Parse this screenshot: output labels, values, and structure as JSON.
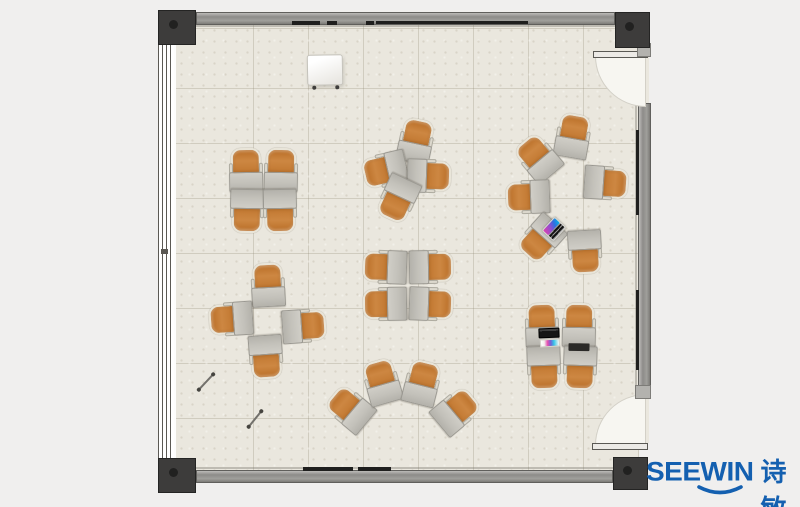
{
  "logo": {
    "brand": "SEEWIN",
    "brand_cn": "诗敏",
    "color": "#1460b0"
  },
  "floorplan": {
    "colors": {
      "background": "#f0efee",
      "floor": "#eae7de",
      "wall": "#8d8c89",
      "corner_post": "#3d3c3b",
      "chair": "#c87c37",
      "chair_trim": "#e9e5d9",
      "desk": "#c3c1ba",
      "wall_mark": "#1f1f1e"
    },
    "clusters": [
      {
        "name": "quad-top-left",
        "units": [
          {
            "x": 246,
            "y": 170,
            "r": -1
          },
          {
            "x": 281,
            "y": 170,
            "r": 1
          },
          {
            "x": 247,
            "y": 211,
            "r": 181
          },
          {
            "x": 280,
            "y": 211,
            "r": 179
          }
        ]
      },
      {
        "name": "quad-rotated-top-center",
        "units": [
          {
            "x": 416,
            "y": 141,
            "r": 12
          },
          {
            "x": 385,
            "y": 170,
            "r": -103
          },
          {
            "x": 429,
            "y": 176,
            "r": 92
          },
          {
            "x": 398,
            "y": 199,
            "r": -155
          }
        ]
      },
      {
        "name": "circle-right",
        "units": [
          {
            "x": 573,
            "y": 136,
            "r": 10
          },
          {
            "x": 538,
            "y": 158,
            "r": -40
          },
          {
            "x": 528,
            "y": 197,
            "r": -92
          },
          {
            "x": 541,
            "y": 239,
            "r": -138
          },
          {
            "x": 585,
            "y": 252,
            "r": 177
          },
          {
            "x": 606,
            "y": 183,
            "r": 94
          }
        ]
      },
      {
        "name": "quad-center",
        "units": [
          {
            "x": 385,
            "y": 267,
            "r": -88
          },
          {
            "x": 385,
            "y": 304,
            "r": -91
          },
          {
            "x": 431,
            "y": 267,
            "r": 89
          },
          {
            "x": 431,
            "y": 304,
            "r": 92
          }
        ]
      },
      {
        "name": "cross-left",
        "units": [
          {
            "x": 268,
            "y": 285,
            "r": -3
          },
          {
            "x": 231,
            "y": 319,
            "r": -94
          },
          {
            "x": 304,
            "y": 326,
            "r": 86
          },
          {
            "x": 266,
            "y": 357,
            "r": 176
          }
        ]
      },
      {
        "name": "arc-bottom-center",
        "units": [
          {
            "x": 350,
            "y": 409,
            "r": -50
          },
          {
            "x": 382,
            "y": 382,
            "r": -16
          },
          {
            "x": 422,
            "y": 383,
            "r": 14
          },
          {
            "x": 456,
            "y": 411,
            "r": 50
          }
        ]
      },
      {
        "name": "quad-bottom-right",
        "units": [
          {
            "x": 542,
            "y": 325,
            "r": -2
          },
          {
            "x": 579,
            "y": 325,
            "r": 1
          },
          {
            "x": 544,
            "y": 368,
            "r": 178
          },
          {
            "x": 580,
            "y": 368,
            "r": 182
          }
        ]
      }
    ],
    "objects": [
      {
        "type": "flipchart",
        "name": "flipchart-board",
        "x": 325,
        "y": 70,
        "w": 34,
        "h": 29,
        "r": -1
      },
      {
        "type": "open-laptop",
        "name": "open-laptop",
        "x": 554,
        "y": 229,
        "w": 19,
        "h": 16,
        "r": -47
      },
      {
        "type": "laptop",
        "name": "laptop",
        "x": 549,
        "y": 333,
        "w": 21,
        "h": 10,
        "r": -2
      },
      {
        "type": "papers",
        "name": "paper-stack",
        "x": 550,
        "y": 343,
        "w": 20,
        "h": 8,
        "r": -3
      },
      {
        "type": "tablet",
        "name": "tablet",
        "x": 579,
        "y": 347,
        "w": 21,
        "h": 7,
        "r": 1
      },
      {
        "type": "pen",
        "name": "pen",
        "x": 206,
        "y": 382,
        "w": 21,
        "h": 2,
        "r": -47
      },
      {
        "type": "pen",
        "name": "pen",
        "x": 255,
        "y": 419,
        "w": 20,
        "h": 2,
        "r": -51
      }
    ],
    "wall_marks": [
      {
        "x": 292,
        "y": 21,
        "w": 28,
        "h": 4
      },
      {
        "x": 327,
        "y": 21,
        "w": 10,
        "h": 4
      },
      {
        "x": 366,
        "y": 21,
        "w": 8,
        "h": 4
      },
      {
        "x": 376,
        "y": 21,
        "w": 152,
        "h": 3
      },
      {
        "x": 303,
        "y": 467,
        "w": 50,
        "h": 4
      },
      {
        "x": 358,
        "y": 467,
        "w": 33,
        "h": 4
      },
      {
        "x": 636,
        "y": 130,
        "w": 3,
        "h": 85
      },
      {
        "x": 636,
        "y": 290,
        "w": 3,
        "h": 80
      }
    ]
  }
}
